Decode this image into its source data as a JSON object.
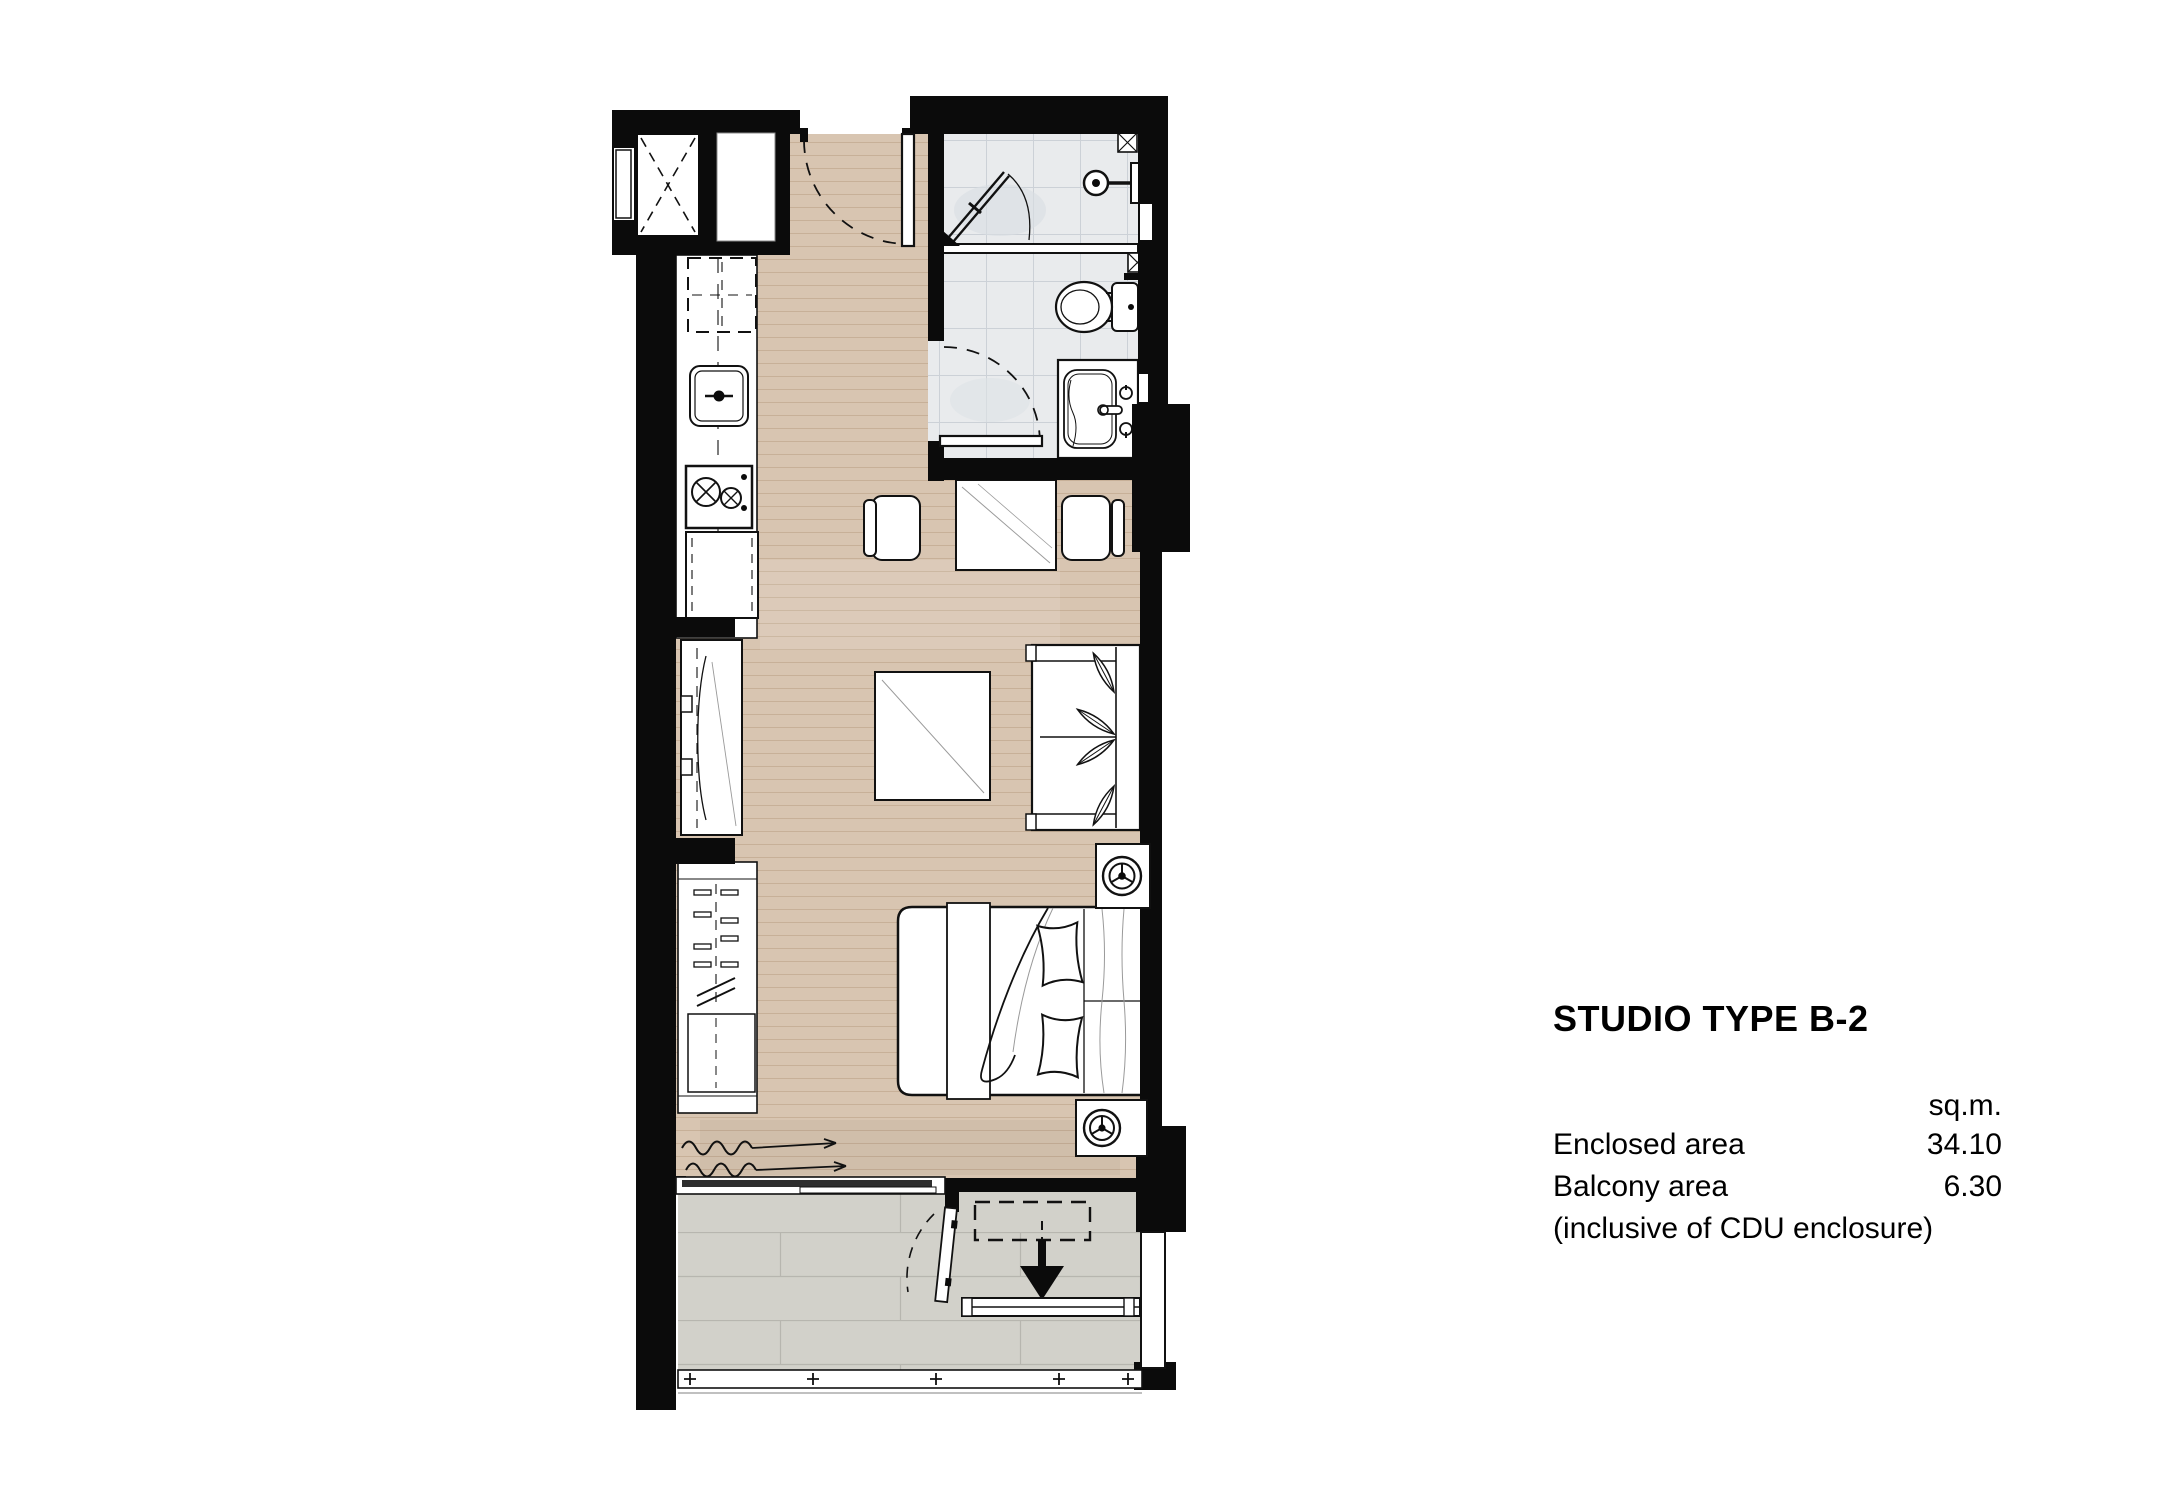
{
  "title_block": {
    "title": "STUDIO TYPE B-2",
    "unit_header": "sq.m.",
    "rows": [
      {
        "label": "Enclosed area",
        "value": "34.10"
      },
      {
        "label": "Balcony area",
        "value": "6.30"
      }
    ],
    "note": "(inclusive of CDU enclosure)"
  },
  "colors": {
    "wall": "#0b0b0b",
    "wood-floor": "#d8c5b1",
    "wood-grain": "#b99e83",
    "bath-floor": "#e9ebed",
    "bath-grout": "#ccd1d7",
    "balcony-floor": "#d2d1ca",
    "balcony-grout": "#b7b6af",
    "fixture-stroke": "#111111",
    "text": "#000000",
    "page-bg": "#ffffff"
  },
  "floorplan": {
    "areas": [
      "living-sleeping-area",
      "kitchenette",
      "bathroom",
      "balcony",
      "cdu-enclosure",
      "utility-shaft",
      "built-in-closet"
    ],
    "fixtures": [
      "entry-door",
      "bathroom-door",
      "balcony-door",
      "sliding-glass-door",
      "wardrobe",
      "tv-console",
      "kitchen-counter",
      "kitchen-sink",
      "cooktop",
      "refrigerator",
      "base-cabinet",
      "dining-table",
      "dining-chair",
      "coffee-table",
      "sofa",
      "double-bed",
      "fan-coil-unit",
      "shower",
      "shower-head",
      "floor-drain",
      "glass-partition",
      "toilet",
      "vanity-basin",
      "curtain",
      "condensing-unit",
      "drain-arrow",
      "louver-screen",
      "balcony-railing"
    ]
  }
}
